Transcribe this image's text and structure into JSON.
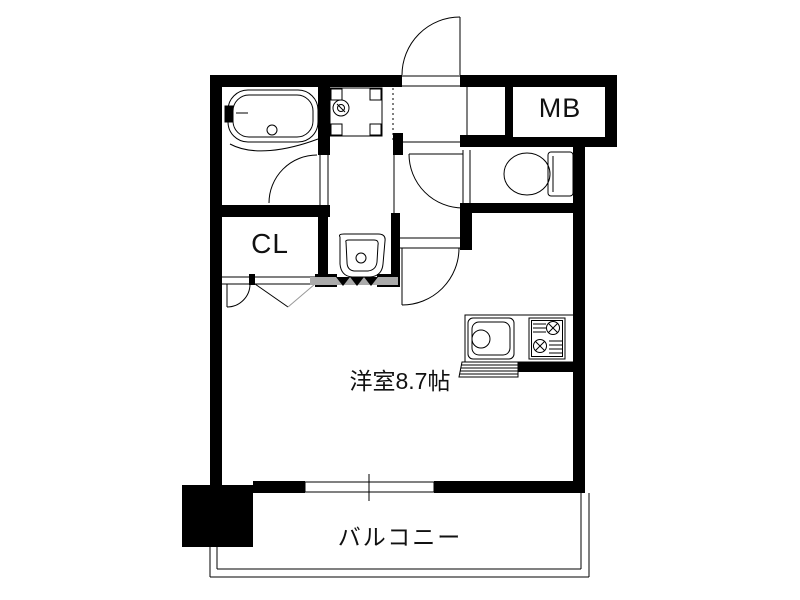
{
  "floorplan": {
    "labels": {
      "meter_box": "MB",
      "closet": "CL",
      "main_room": "洋室8.7帖",
      "balcony": "バルコニー"
    },
    "colors": {
      "wall": "#000000",
      "line": "#000000",
      "accordion_gray": "#aaaaaa",
      "fold_door_gray": "#999999",
      "background": "#ffffff"
    },
    "fixtures": [
      "bathtub",
      "washing-machine-pan",
      "wash-basin",
      "toilet",
      "kitchen-sink",
      "gas-stove"
    ],
    "features": [
      "entrance-door",
      "toilet-door",
      "bathroom-door",
      "main-room-door",
      "closet-folding-door",
      "accordion-door",
      "balcony-window",
      "balcony-railing",
      "corner-pillar"
    ]
  }
}
